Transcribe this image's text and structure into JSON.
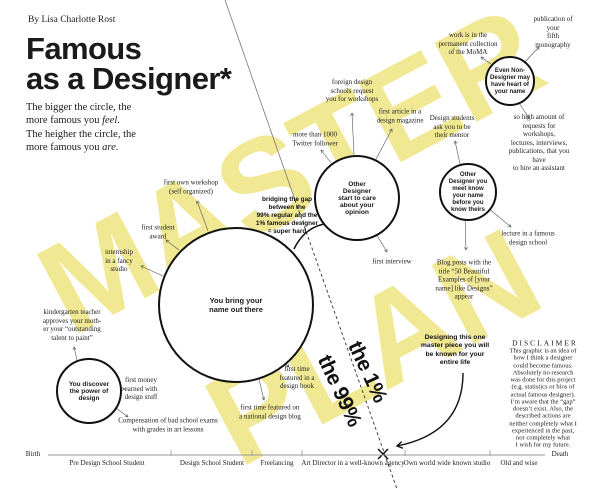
{
  "header": {
    "byline": "By Lisa Charlotte Rost",
    "title_line1": "Famous",
    "title_line2": "as a Designer*",
    "subtitle": "The bigger the circle, the\nmore famous you *feel*.\nThe heigher the circle, the\nmore famous you *are*."
  },
  "watermark": {
    "line1": "MASTER",
    "line2": "PLAN",
    "color": "#F1E894"
  },
  "circles": [
    {
      "id": "discover-power",
      "label": "You discover\nthe power of\ndesign"
    },
    {
      "id": "bring-name-out",
      "label": "You bring your\nname out there"
    },
    {
      "id": "designers-care-opinion",
      "label": "Other\nDesigner\nstart to care\nabout your\nopinion"
    },
    {
      "id": "designers-know-name",
      "label": "Other\nDesigner you\nmeet know\nyour name\nbefore you\nknow theirs"
    },
    {
      "id": "non-designers-know",
      "label": "Even Non-\nDesigner may\nhave heart of\nyour name"
    }
  ],
  "milestones": [
    {
      "id": "first-own-workshop",
      "text": "first own workshop\n(self organized)"
    },
    {
      "id": "first-student-award",
      "text": "first student\naward"
    },
    {
      "id": "internship-fancy-studio",
      "text": "internship\nin a fancy\nstudio"
    },
    {
      "id": "kindergarten-teacher",
      "text": "kindergarten teacher\napproves your moth-\ner your “outstanding\ntalent to paint”"
    },
    {
      "id": "first-money",
      "text": "first money\nearned with\ndesign stuff"
    },
    {
      "id": "compensation-exams",
      "text": "Compensation of bad school exams\nwith grades in art lessons"
    },
    {
      "id": "featured-design-blog",
      "text": "first time featured on\na national design blog"
    },
    {
      "id": "featured-design-book",
      "text": "first time\nfeatured in a\ndesign book"
    },
    {
      "id": "twitter-followers",
      "text": "more than 1000\nTwitter follower"
    },
    {
      "id": "foreign-schools",
      "text": "foreign design\nschools request\nyou for workshops"
    },
    {
      "id": "first-article",
      "text": "first article in a\ndesign magazine"
    },
    {
      "id": "first-interview",
      "text": "first interview"
    },
    {
      "id": "design-students-mentor",
      "text": "Design students\nask you to be\ntheir mentor"
    },
    {
      "id": "blog-posts-title",
      "text": "Blog posts with the\ntitle “50 Beautiful\nExamples of [your\nname] like Designs”\nappear"
    },
    {
      "id": "lecture-famous-school",
      "text": "lecture in a famous\ndesign school"
    },
    {
      "id": "moma-collection",
      "text": "work is in the\npermanent collection\nof the MoMA"
    },
    {
      "id": "fifth-monography",
      "text": "publication of your\nfifth monography"
    },
    {
      "id": "hire-assistant",
      "text": "so high amount of\nrequests for workshops,\nlectures, interviews,\npublications, that you have\nto hire an assistant"
    }
  ],
  "gap": {
    "label_top": "the 1%",
    "label_bottom": "the 99%",
    "bridging_note": "bridging the gap\nbetween the\n99% regular and the\n1% famous designer\n= super hard",
    "masterpiece_note": "Designing this one\nmaster piece you will\nbe known for your\nentire life"
  },
  "timeline": {
    "start_label": "Birth",
    "end_label": "Death",
    "stages": [
      "Pre Design School Student",
      "Design School Student",
      "Freelancing",
      "Art Director in a well-known agency",
      "Own world wide known studio",
      "Old and wise"
    ]
  },
  "disclaimer": {
    "heading": "DISCLAIMER",
    "body": "This graphic is an idea of\nhow I think a designer\ncould become famous.\nAbsolutely no research\nwas done for this project\n(e.g. statistics or bios of\nactual famous designer).\nI’m aware that the “gap”\ndoesn’t exist. Also, the\ndescribed actions are\nneither completely what I\nexperienced in the past,\nnor completely what\nI wish for my future."
  }
}
